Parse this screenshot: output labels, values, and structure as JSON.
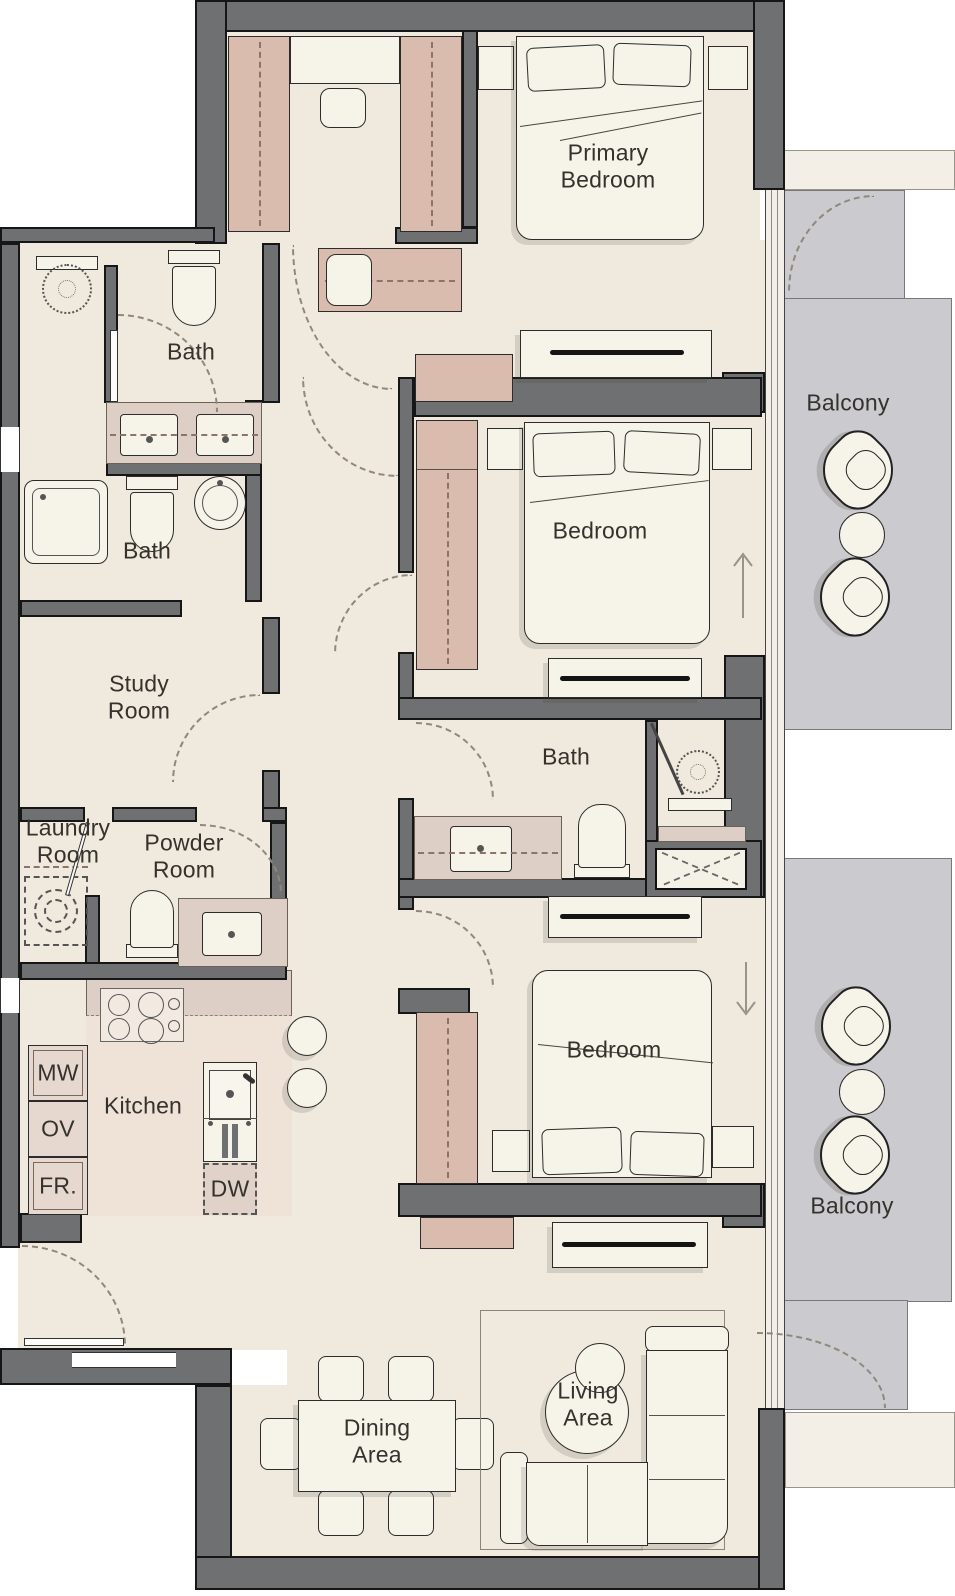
{
  "plan": {
    "type": "apartment-floor-plan",
    "rooms": {
      "primary_bedroom": {
        "label": "Primary\nBedroom"
      },
      "bath_top_left": {
        "label": "Bath"
      },
      "bath_left": {
        "label": "Bath"
      },
      "bath_middle": {
        "label": "Bath"
      },
      "study_room": {
        "label": "Study\nRoom"
      },
      "laundry_room": {
        "label": "Laundry\nRoom"
      },
      "powder_room": {
        "label": "Powder\nRoom"
      },
      "kitchen": {
        "label": "Kitchen"
      },
      "bedroom_middle": {
        "label": "Bedroom"
      },
      "bedroom_lower": {
        "label": "Bedroom"
      },
      "balcony_upper": {
        "label": "Balcony"
      },
      "balcony_lower": {
        "label": "Balcony"
      },
      "dining_area": {
        "label": "Dining\nArea"
      },
      "living_area": {
        "label": "Living\nArea"
      }
    },
    "appliances": {
      "microwave": {
        "label": "MW"
      },
      "oven": {
        "label": "OV"
      },
      "fridge": {
        "label": "FR."
      },
      "dishwasher": {
        "label": "DW"
      }
    },
    "colors": {
      "wall": "#6e7071",
      "floor": "#f0e9dd",
      "kitchen_floor": "#efe3d8",
      "balcony_floor": "#cbcbcf",
      "cabinet": "#d9bcae",
      "counter": "#ddcfc6",
      "furniture": "#f6f3e9",
      "outline": "#1c1c1c"
    }
  }
}
